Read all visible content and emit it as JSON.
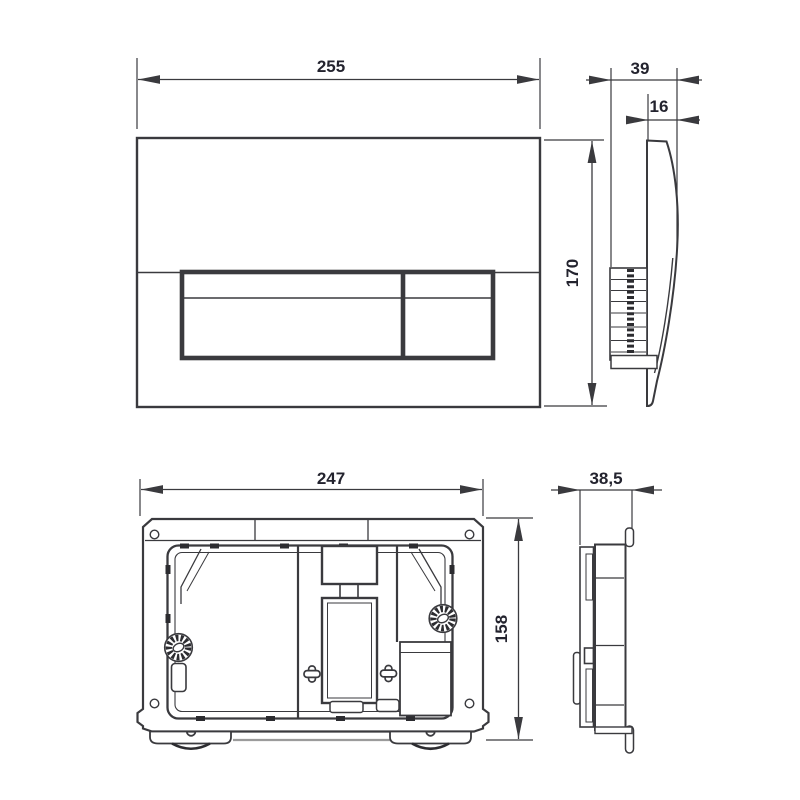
{
  "drawing": {
    "background": "#ffffff",
    "line_color": "#3a3a3e",
    "heavy_line_color": "#2c2c30",
    "text_color": "#23232e",
    "muted_line_color": "#9b9b9b",
    "dimensions": {
      "front_width": "255",
      "front_height": "170",
      "side_depth": "39",
      "plate_thickness": "16",
      "frame_width": "247",
      "frame_height": "158",
      "frame_depth": "38,5"
    }
  }
}
